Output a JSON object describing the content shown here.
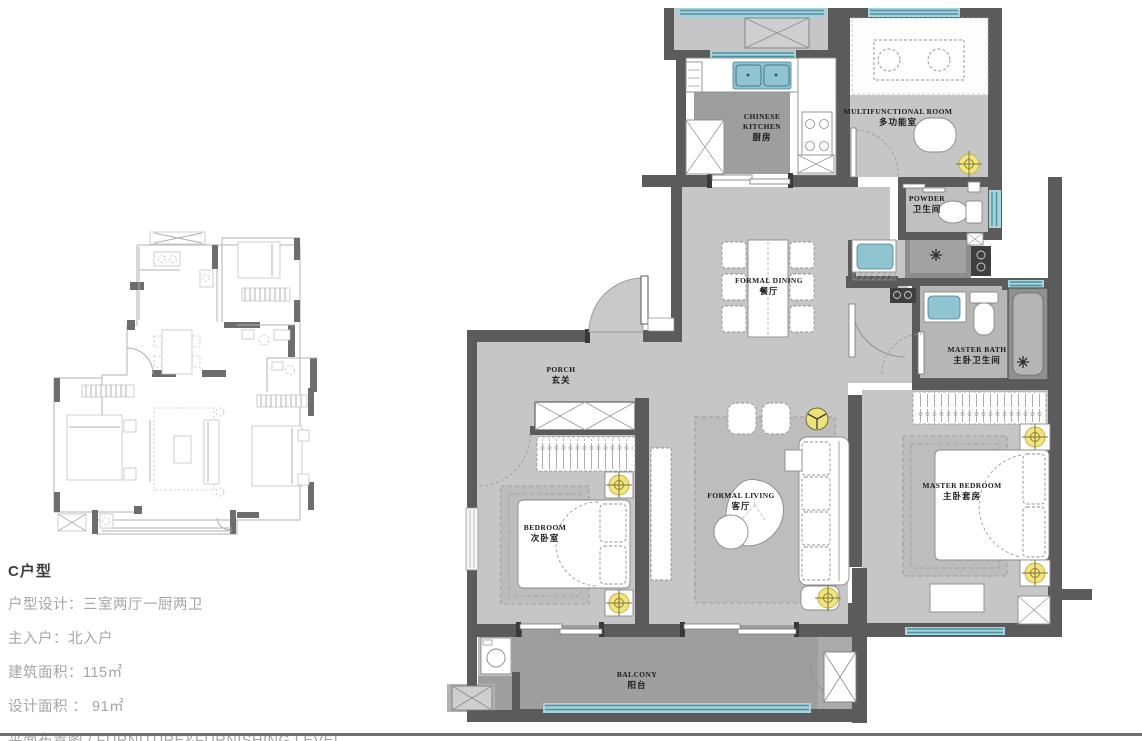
{
  "info": {
    "title": "C户型",
    "lines": [
      "户型设计：三室两厅一厨两卫",
      "主入户：北入户",
      "建筑面积：115㎡",
      "设计面积 ： 91㎡",
      "平面布置图 / FURNITURE&FURNISHING LEVEL"
    ]
  },
  "rooms": [
    {
      "id": "chinese-kitchen",
      "en": "CHINESE\nKITCHEN",
      "cn": "厨房"
    },
    {
      "id": "multifunctional-room",
      "en": "MULTIFUNCTIONAL ROOM",
      "cn": "多功能室"
    },
    {
      "id": "powder",
      "en": "POWDER",
      "cn": "卫生间"
    },
    {
      "id": "formal-dining",
      "en": "FORMAL DINING",
      "cn": "餐厅"
    },
    {
      "id": "master-bath",
      "en": "MASTER BATH",
      "cn": "主卧卫生间"
    },
    {
      "id": "porch",
      "en": "PORCH",
      "cn": "玄关"
    },
    {
      "id": "formal-living",
      "en": "FORMAL LIVING",
      "cn": "客厅"
    },
    {
      "id": "bedroom",
      "en": "BEDROOM",
      "cn": "次卧室"
    },
    {
      "id": "master-bedroom",
      "en": "MASTER BEDROOM",
      "cn": "主卧套房"
    },
    {
      "id": "balcony",
      "en": "BALCONY",
      "cn": "阳台"
    }
  ],
  "colors": {
    "wall": "#5b5b5b",
    "floor": "#c6c6c6",
    "floor_dark": "#9e9e9e",
    "window_glass": "#a7d3dc",
    "window_frame": "#4e8fa0",
    "fixture_teal": "#8fc4d0",
    "lamp_yellow": "#f2e47e",
    "page_rule": "#6e6e6e"
  }
}
